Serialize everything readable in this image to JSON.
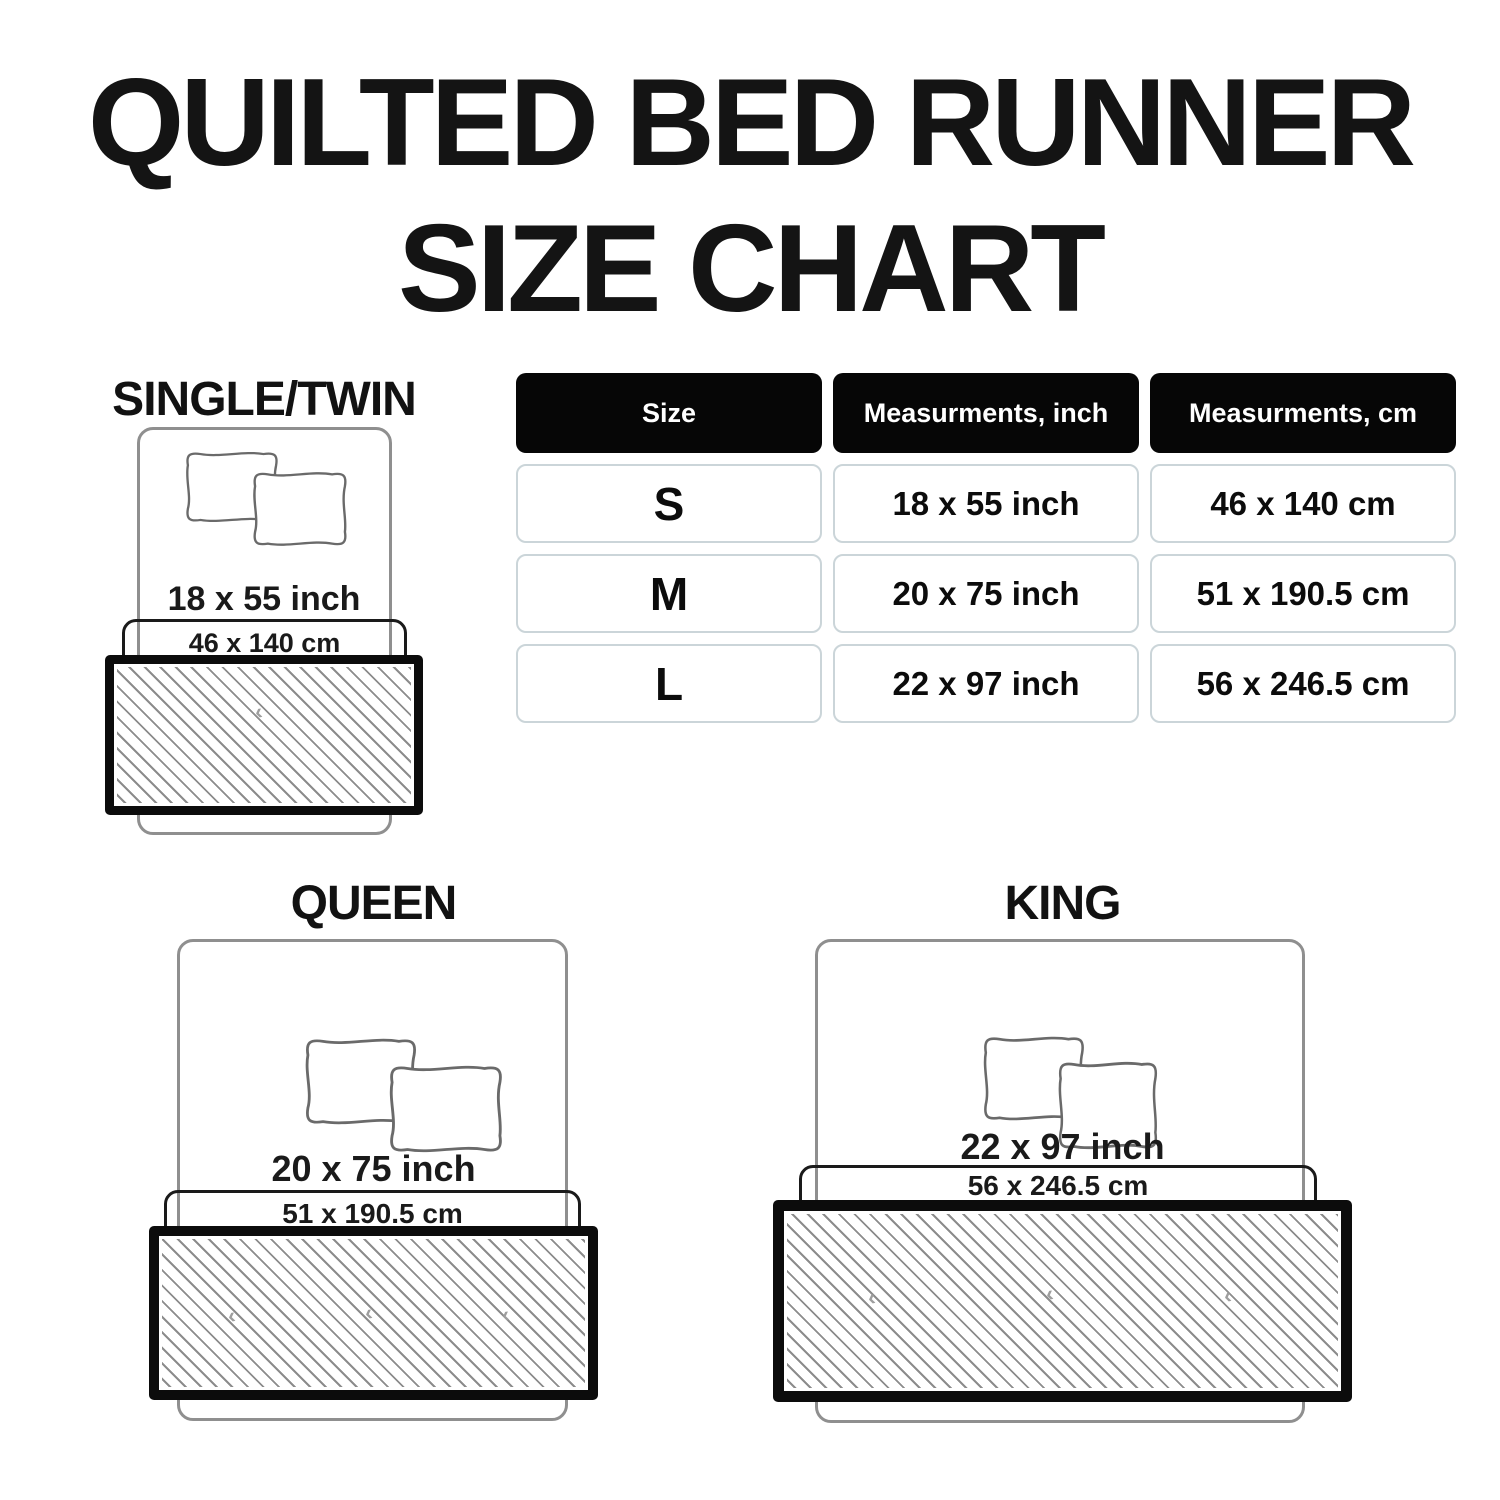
{
  "title": {
    "line1": "QUILTED BED RUNNER",
    "line2": "SIZE CHART"
  },
  "table": {
    "headers": [
      "Size",
      "Measurments, inch",
      "Measurments, cm"
    ],
    "rows": [
      {
        "size": "S",
        "inch": "18 x 55 inch",
        "cm": "46 x 140 cm"
      },
      {
        "size": "M",
        "inch": "20 x 75 inch",
        "cm": "51 x 190.5 cm"
      },
      {
        "size": "L",
        "inch": "22 x 97 inch",
        "cm": "56 x 246.5 cm"
      }
    ]
  },
  "diagrams": [
    {
      "label": "SINGLE/TWIN",
      "inch": "18 x 55 inch",
      "cm": "46 x 140 cm"
    },
    {
      "label": "QUEEN",
      "inch": "20 x 75 inch",
      "cm": "51 x 190.5 cm"
    },
    {
      "label": "KING",
      "inch": "22 x 97 inch",
      "cm": "56 x 246.5 cm"
    }
  ],
  "colors": {
    "ink": "#0d0d0d",
    "header_bg": "#060606",
    "header_text": "#ffffff",
    "cell_border": "#cbd5d9",
    "bed_outline": "#8f8f8f",
    "hatch_line": "#8c8c8c",
    "background": "#ffffff"
  }
}
